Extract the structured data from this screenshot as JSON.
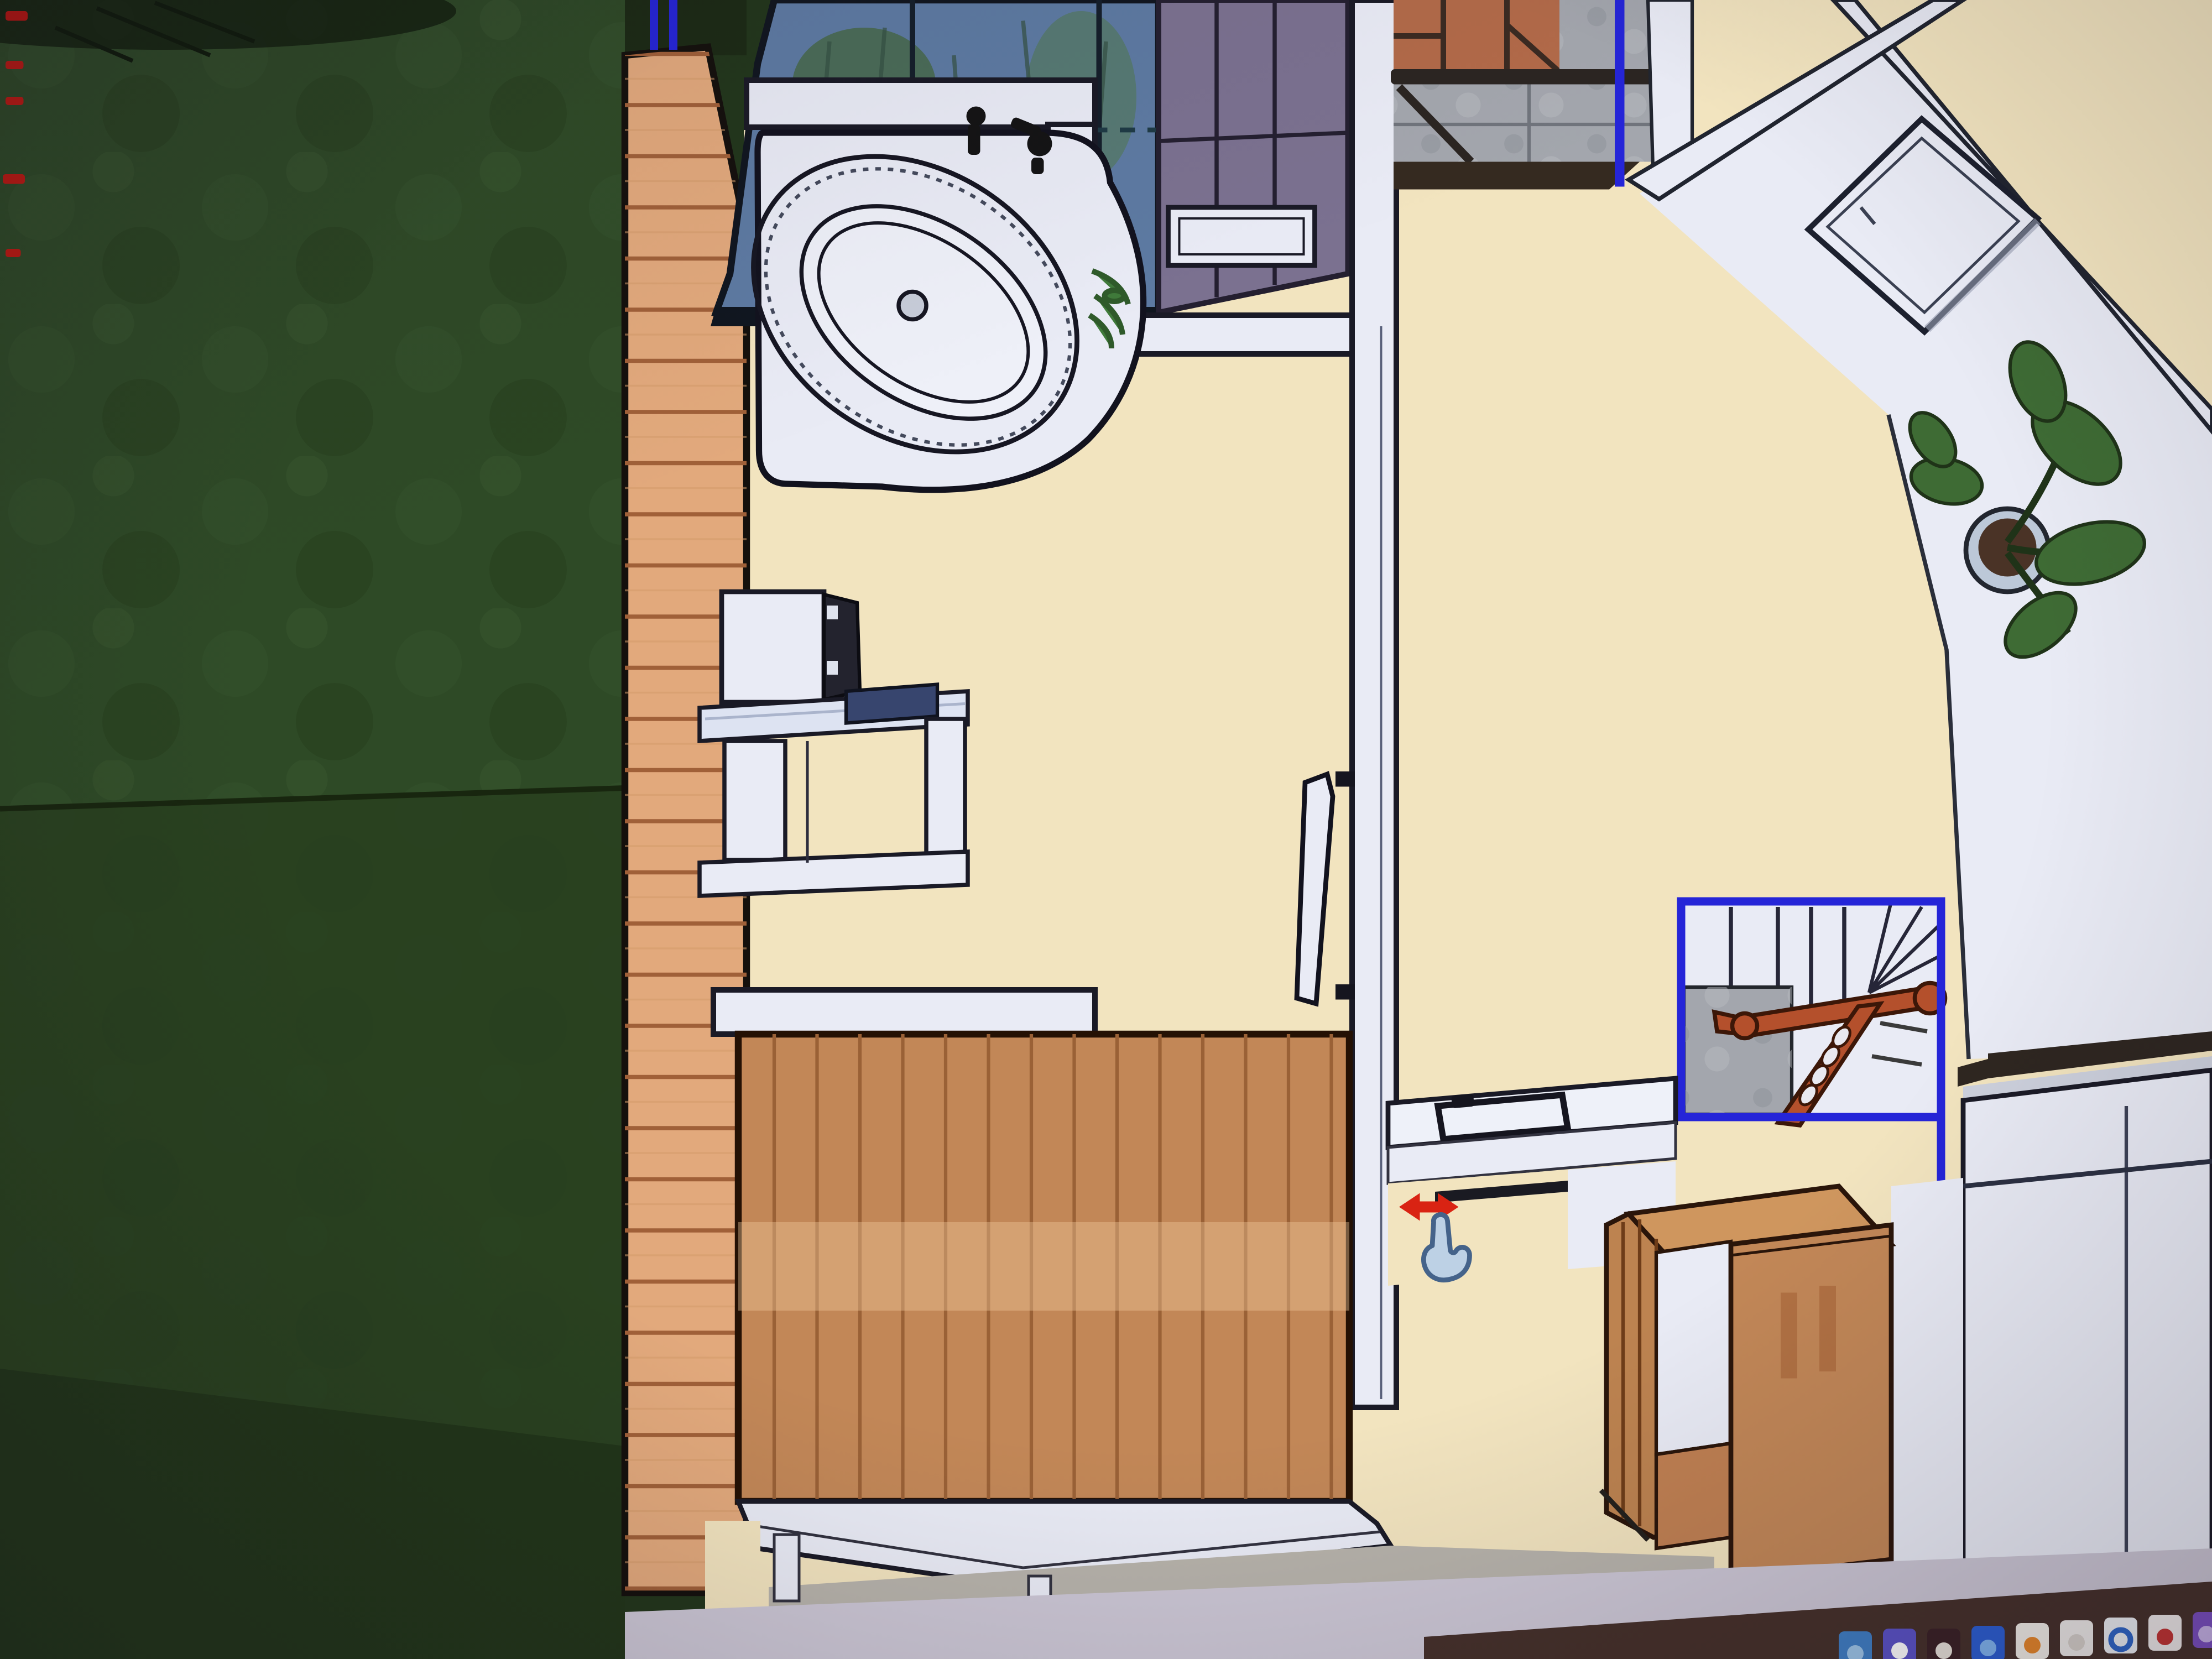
{
  "app": {
    "name": "3d-home-design-floor-plan",
    "view": "top-down 3D rendered floor plan, photographed on a monitor",
    "visible_text": "none"
  },
  "cursor": {
    "icon": "pan-hand-with-red-horizontal-double-arrow",
    "position_pct": {
      "x": 65,
      "y": 74
    }
  },
  "selection": {
    "highlight_color": "#2525d8",
    "selected": [
      "staircase",
      "entry-wall-edge",
      "roof-edge-lines"
    ]
  },
  "colors": {
    "grass": "#2e4a26",
    "grass2": "#28401f",
    "deck": "#e2a97c",
    "floor": "#f2e4bf",
    "wall": "#e9ebf5",
    "outline": "#1a1a26",
    "glass": "#5d7aa2",
    "roof2": "#7b7190",
    "tile": "#b26a49",
    "stone": "#a3a6ad",
    "railing": "#2b2522",
    "select": "#2525d8",
    "wood": "#c28757",
    "rail_red": "#b4502c",
    "band": "#ccc7d5",
    "brown": "#45302a",
    "cursor_red": "#d92313",
    "cursor_hand": "#bdd1e5"
  },
  "scene": {
    "style": "top-down 3D architectural render",
    "regions": [
      {
        "name": "garden-lawn",
        "desc": "dark green grass strip, full left side"
      },
      {
        "name": "wooden-deck-strip",
        "desc": "vertical light-wood plank deck between lawn and house"
      },
      {
        "name": "glass-roof",
        "desc": "blue glazed roof with plants visible beneath, dashed frame line"
      },
      {
        "name": "tiled-roof-section",
        "desc": "mauve gridded roof right of the glass roof"
      },
      {
        "name": "bathroom",
        "desc": "room with white corner bathtub and faucet"
      },
      {
        "name": "hallway-room",
        "desc": "cream floor, tall white cabinet, interior door in center wall"
      },
      {
        "name": "entry-balcony",
        "desc": "terracotta tiles, grey stone tiles, dark railing, blue selected edge"
      },
      {
        "name": "terrace-corridor",
        "desc": "diagonal white corridor with square table and potted plant"
      },
      {
        "name": "stair-hall",
        "desc": "staircase with winder treads outlined in blue selection"
      },
      {
        "name": "kitchen-area",
        "desc": "counter with tray, drawer handle, tall white unit with dark top"
      },
      {
        "name": "dressing-area",
        "desc": "wooden wardrobe on cream floor near white plinth"
      }
    ],
    "objects": [
      {
        "name": "corner-bathtub"
      },
      {
        "name": "bath-faucet"
      },
      {
        "name": "bath-drain"
      },
      {
        "name": "roof-window"
      },
      {
        "name": "tall-double-door-cabinet"
      },
      {
        "name": "interior-door"
      },
      {
        "name": "vanity-desk-with-dark-appliance"
      },
      {
        "name": "wood-paneled-closet"
      },
      {
        "name": "white-plinth-platform"
      },
      {
        "name": "square-side-table"
      },
      {
        "name": "potted-plant"
      },
      {
        "name": "staircase"
      },
      {
        "name": "red-stair-handrail"
      },
      {
        "name": "stone-pillar"
      },
      {
        "name": "kitchen-counter"
      },
      {
        "name": "serving-tray"
      },
      {
        "name": "drawer-handle"
      },
      {
        "name": "tall-kitchen-unit"
      },
      {
        "name": "wooden-wardrobe"
      },
      {
        "name": "concrete-floor-patch"
      }
    ]
  },
  "taskbar": {
    "desc": "row of app icons cut off at bottom-right edge of the photo",
    "icons": [
      {
        "name": "blue-app-icon",
        "color": "#3f7ec4",
        "accent": "#9cc4e8"
      },
      {
        "name": "purple-app-icon",
        "color": "#5a52c6",
        "accent": "#ffffff"
      },
      {
        "name": "dark-wedge-app-icon",
        "color": "#3a2126",
        "accent": "#e8e2da"
      },
      {
        "name": "blue-swoosh-app-icon",
        "color": "#2c5ed2",
        "accent": "#7fb3f0"
      },
      {
        "name": "white-flame-app-icon",
        "color": "#f3efe9",
        "accent": "#e8872a"
      },
      {
        "name": "white-slab-app-icon",
        "color": "#efecea",
        "accent": "#d8d2cc"
      },
      {
        "name": "blue-ring-app-icon",
        "color": "#eef1f5",
        "accent": "#2f66c8"
      },
      {
        "name": "white-red-glyph-app-icon",
        "color": "#f1ecec",
        "accent": "#c43333"
      },
      {
        "name": "purple-figure-app-icon",
        "color": "#7b4fc2",
        "accent": "#c9b4ea"
      }
    ]
  }
}
